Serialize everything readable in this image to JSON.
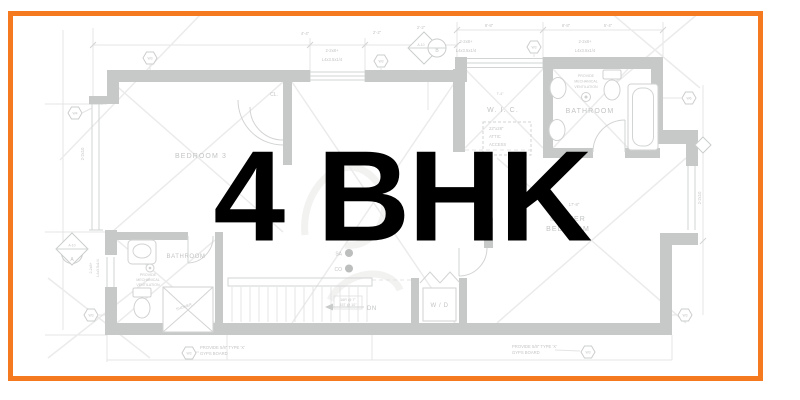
{
  "frame": {
    "accent_color": "#F5791F"
  },
  "overlay": {
    "title": "4 BHK",
    "color": "#000000"
  },
  "plan": {
    "ink_color": "#C7C9C8",
    "rooms": {
      "bedroom3": "BEDROOM 3",
      "wic": "W. I. C.",
      "bathroom_top": "BATHROOM",
      "bathroom_bottom": "BATHROOM",
      "master_line1": "MASTER",
      "master_line2": "BEDROOM",
      "closet": "CL.",
      "washer_dryer": "W / D"
    },
    "stairs": {
      "dn": "DN",
      "risers": "16R @ 7\"",
      "treads": "15T @ 10\""
    },
    "detectors": {
      "sa": "SA",
      "co": "CO"
    },
    "notes": {
      "vent1": "PROVIDE",
      "vent2": "MECHANICAL",
      "vent3": "VENTILATION",
      "gyps1": "PROVIDE 5/8\" TYPE 'X'",
      "gyps2": "GYPS BOARD",
      "attic1": "22\"x28\"",
      "attic2": "ATTIC",
      "attic3": "ACCESS",
      "shower": "SHOWER"
    },
    "framing": {
      "beam1": "2-2x8+",
      "beam2": "L4x3.5x1/4",
      "joist": "2-2x10"
    },
    "symbols": {
      "w3": "W3",
      "w4": "W4",
      "w6": "W6",
      "a10": "A-10",
      "a": "A",
      "b": "B"
    },
    "dims": {
      "d1": "4'-4\"",
      "d2": "2'-2\"",
      "d3": "8'-8\"",
      "d4": "5'-4\"",
      "d5": "7'-4\"",
      "d6": "17'-8\""
    }
  }
}
